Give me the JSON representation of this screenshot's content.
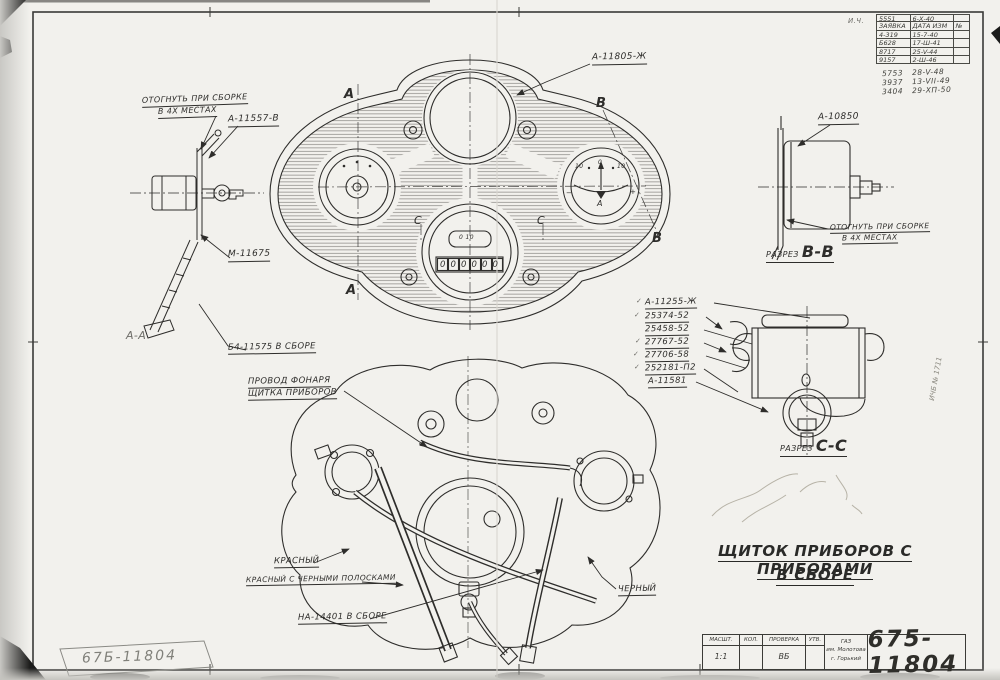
{
  "colors": {
    "paper": "#f2f1ed",
    "ink": "#2e2d2b",
    "pencil": "#b7b3a7"
  },
  "upper_view": {
    "label_part": "А-11805-Ж",
    "bend_note_line1": "ОТОГНУТЬ ПРИ СБОРКЕ",
    "bend_note_line2": "В 4Х МЕСТАХ",
    "label_bracket": "А-11557-В",
    "label_cable_nut": "М-11675",
    "label_assembly": "Б4-11575 В СБОРЕ",
    "section_a": "А",
    "section_b": "В",
    "section_c": "С",
    "side_view_caption": "А-А",
    "ammeter": {
      "scale_left": "10",
      "scale_mid": "0",
      "scale_right": "10",
      "minus": "−",
      "plus": "+",
      "letter": "А"
    },
    "speedometer": {
      "window_text": "0 10",
      "odometer_digits": [
        "0",
        "0",
        "0",
        "0",
        "0",
        "0"
      ]
    }
  },
  "section_bb": {
    "label_part": "А-10850",
    "bend_note_line1": "ОТОГНУТЬ ПРИ СБОРКЕ",
    "bend_note_line2": "В 4Х МЕСТАХ",
    "caption_prefix": "РАЗРЕЗ",
    "caption_letters": "В-В"
  },
  "section_cc": {
    "caption_prefix": "РАЗРЕЗ",
    "caption_letters": "С-С",
    "checkmark": "✓",
    "parts": [
      "А-11255-Ж",
      "25374-52",
      "25458-52",
      "27767-52",
      "27706-58",
      "252181-П2",
      "А-11581"
    ]
  },
  "lower_view": {
    "wire_note_line1": "ПРОВОД ФОНАРЯ",
    "wire_note_line2": "ЩИТКА ПРИБОРОВ",
    "label_red": "КРАСНЫЙ",
    "label_red_striped": "КРАСНЫЙ С ЧЕРНЫМИ ПОЛОСКАМИ",
    "label_cable_assembly": "НА-14401 В СБОРЕ",
    "label_black": "ЧЕРНЫЙ"
  },
  "title": {
    "line1": "ЩИТОК ПРИБОРОВ С ПРИБОРАМИ",
    "line2": "В СБОРЕ"
  },
  "revision_table": {
    "corner_note": "И.Ч.",
    "pre_row": {
      "c1": "5551",
      "c2": "6-Х-40"
    },
    "header": {
      "c1": "ЗАЯВКА",
      "c2": "ДАТА ИЗМ",
      "c3": "№"
    },
    "rows": [
      {
        "c1": "4-319",
        "c2": "15-7-40"
      },
      {
        "c1": "Б628",
        "c2": "17-Ш-41"
      },
      {
        "c1": "8717",
        "c2": "25-V-44"
      },
      {
        "c1": "9157",
        "c2": "2-Ш-46"
      }
    ],
    "handwritten": [
      {
        "c1": "5753",
        "c2": "28-V-48"
      },
      {
        "c1": "3937",
        "c2": "13-VII-49"
      },
      {
        "c1": "3404",
        "c2": "29-ХП-50"
      }
    ]
  },
  "title_block": {
    "scale_label": "МАСШТ.",
    "scale_value": "1:1",
    "qty_label": "КОЛ.",
    "check_label": "ПРОВЕРКА",
    "check_value": "ВБ",
    "approve_label": "УТВ.",
    "factory_line1": "ГАЗ",
    "factory_line2": "им. Молотова",
    "factory_line3": "г. Горький",
    "drawing_number": "675-11804"
  },
  "stamp_number": "67Б-11804",
  "edge_note": "ИЧБ № 1711"
}
